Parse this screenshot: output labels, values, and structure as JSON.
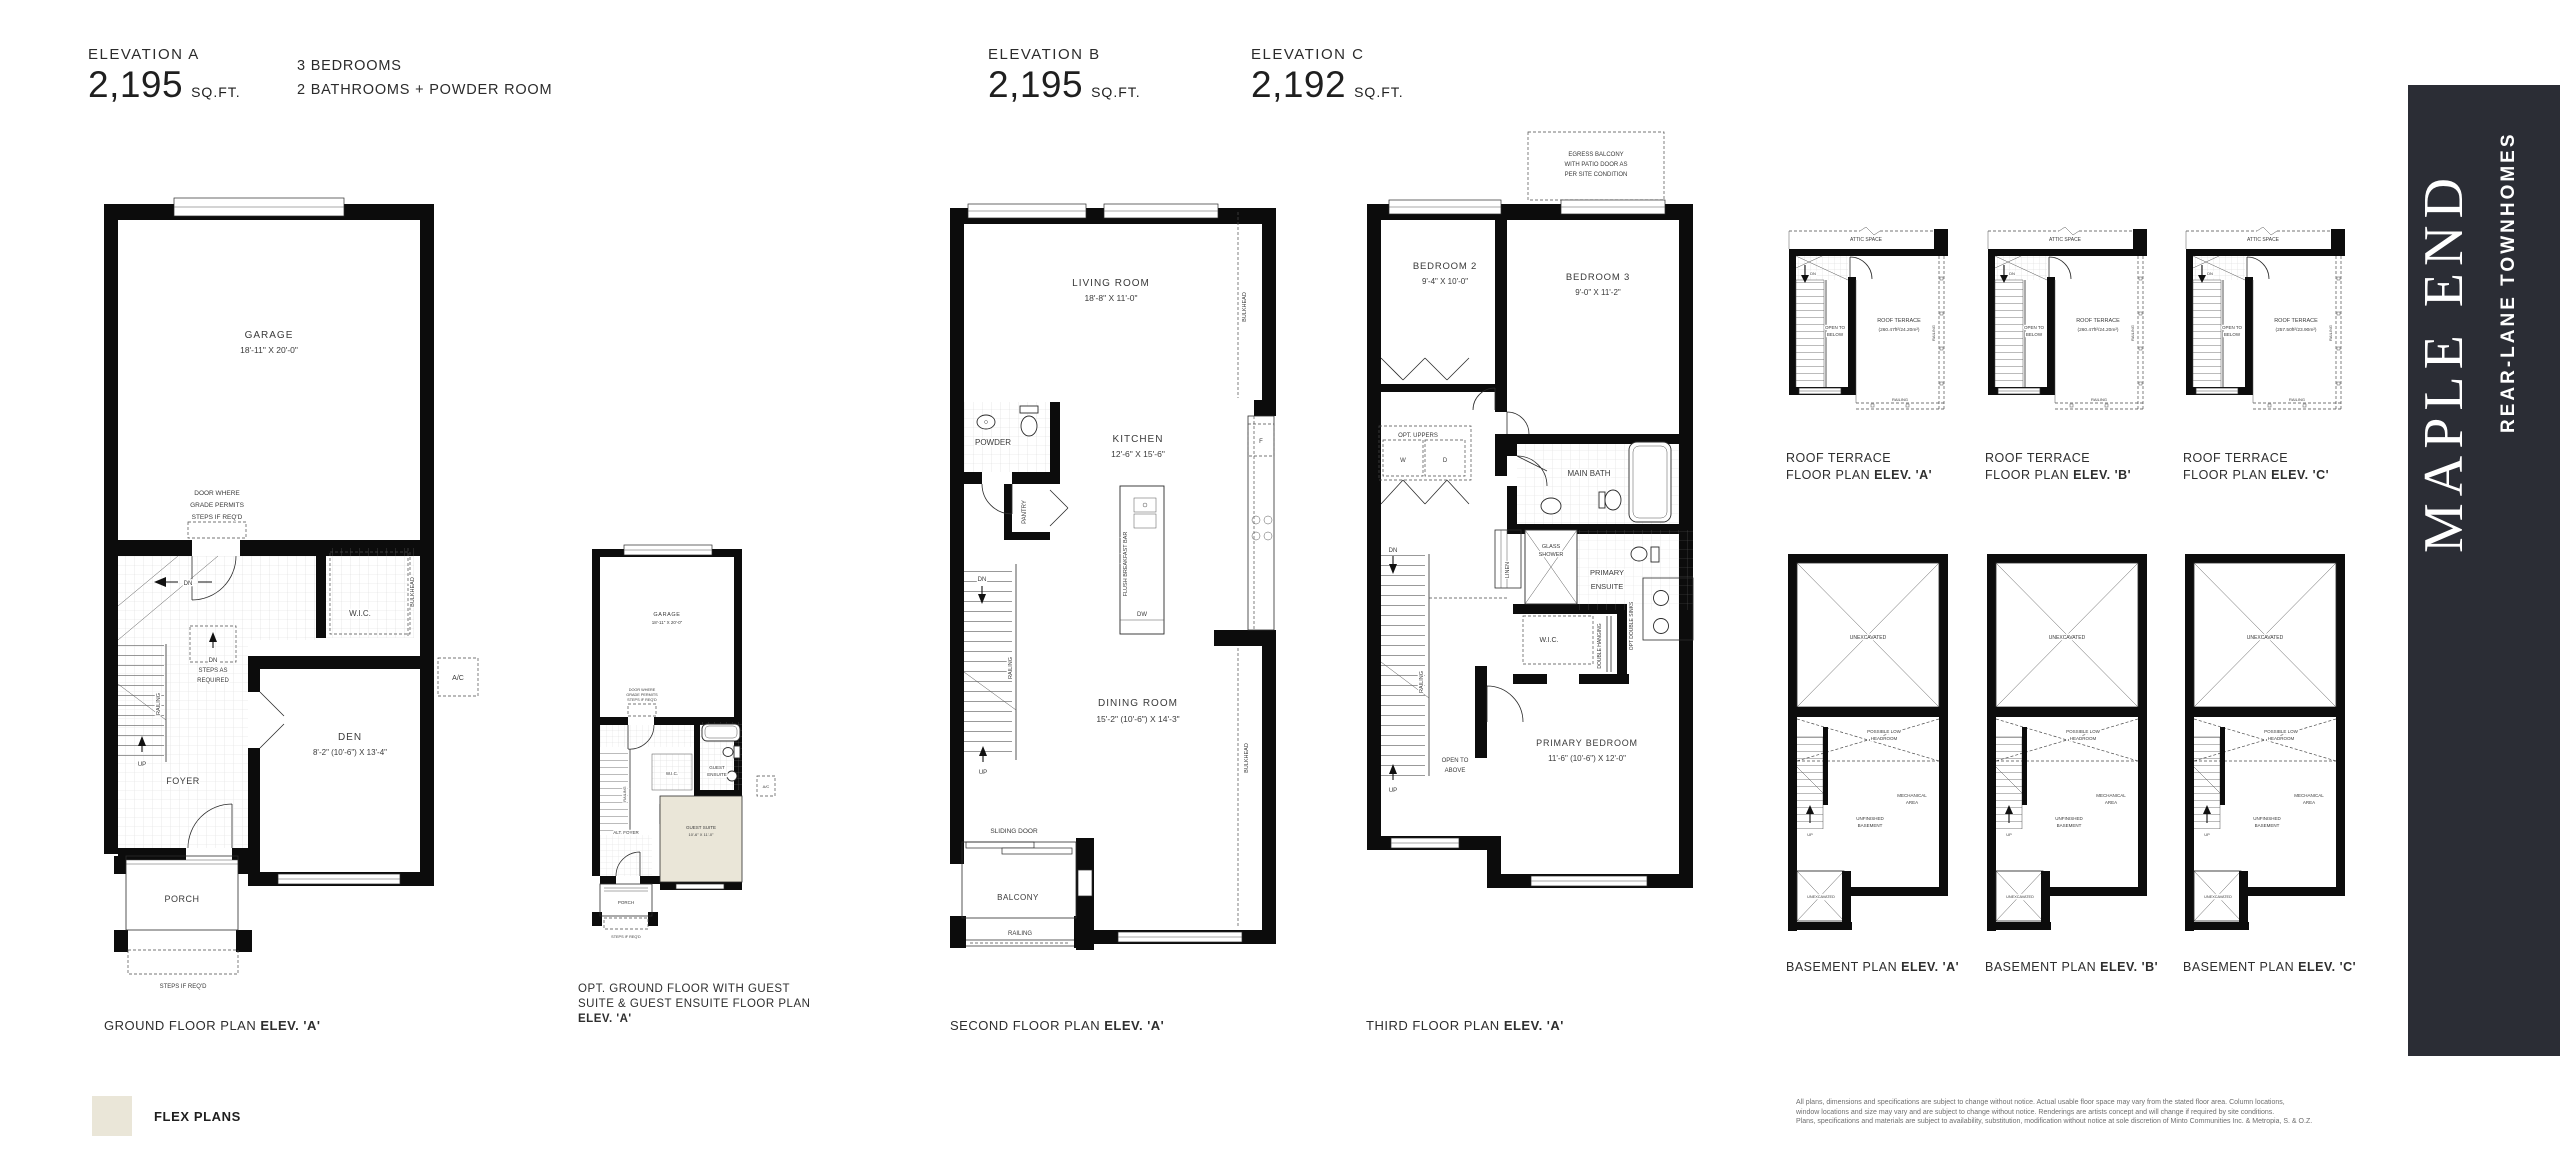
{
  "header": {
    "elevation_a": {
      "label": "ELEVATION A",
      "sqft": "2,195",
      "unit": "SQ.FT."
    },
    "elevation_b": {
      "label": "ELEVATION B",
      "sqft": "2,195",
      "unit": "SQ.FT."
    },
    "elevation_c": {
      "label": "ELEVATION C",
      "sqft": "2,192",
      "unit": "SQ.FT."
    },
    "feature_1": "3 BEDROOMS",
    "feature_2": "2 BATHROOMS + POWDER ROOM"
  },
  "sidebar": {
    "title": "MAPLE END",
    "subtitle": "REAR-LANE TOWNHOMES",
    "bg": "#2b2d35"
  },
  "legend": {
    "label": "FLEX PLANS",
    "swatch_color": "#eae6d8"
  },
  "disclaimer": {
    "line1": "All plans, dimensions and specifications are subject to change without notice. Actual usable floor space may vary from the stated floor area. Column locations,",
    "line2": "window locations and size may vary and are subject to change without notice. Renderings are artists concept and will change if required by site conditions.",
    "line3": "Plans, specifications and materials are subject to availability, substitution, modification without notice at sole discretion of Minto Communities Inc. & Metropia, S. & O.Z."
  },
  "ground": {
    "caption_text": "GROUND FLOOR PLAN",
    "caption_bold": "ELEV. 'A'",
    "garage": "GARAGE",
    "garage_dim": "18'-11\" X 20'-0\"",
    "door_note_1": "DOOR WHERE",
    "door_note_2": "GRADE PERMITS",
    "door_note_3": "STEPS IF REQ'D",
    "wic": "W.I.C.",
    "bulkhead": "BULKHEAD",
    "dn": "DN",
    "steps_1": "DN",
    "steps_2": "STEPS AS",
    "steps_3": "REQUIRED",
    "railing": "RAILING",
    "up": "UP",
    "foyer": "FOYER",
    "den": "DEN",
    "den_dim": "8'-2\" (10'-6\") X 13'-4\"",
    "ac": "A/C",
    "porch": "PORCH",
    "steps_req": "STEPS IF REQ'D"
  },
  "opt_ground": {
    "caption_1": "OPT. GROUND FLOOR WITH GUEST",
    "caption_2": "SUITE & GUEST ENSUITE FLOOR PLAN",
    "caption_bold": "ELEV. 'A'",
    "garage": "GARAGE",
    "garage_dim": "18'-11\" X 20'-0\"",
    "door_note_1": "DOOR WHERE",
    "door_note_2": "GRADE PERMITS",
    "door_note_3": "STEPS IF REQ'D",
    "wic": "W.I.C.",
    "guest_ensuite_1": "GUEST",
    "guest_ensuite_2": "ENSUITE",
    "guest_suite": "GUEST SUITE",
    "guest_suite_dim": "10'-6\" X 11'-0\"",
    "alt_foyer": "ALT. FOYER",
    "railing": "RAILING",
    "porch": "PORCH",
    "steps_req": "STEPS IF REQ'D",
    "ac": "A/C"
  },
  "second": {
    "caption_text": "SECOND FLOOR PLAN",
    "caption_bold": "ELEV. 'A'",
    "living": "LIVING ROOM",
    "living_dim": "18'-8\" X 11'-0\"",
    "bulkhead": "BULKHEAD",
    "powder": "POWDER",
    "kitchen": "KITCHEN",
    "kitchen_dim": "12'-6\" X 15'-6\"",
    "pantry": "PANTRY",
    "breakfast_bar": "FLUSH BREAKFAST BAR",
    "fridge": "F",
    "dw": "DW",
    "dn": "DN",
    "railing": "RAILING",
    "up": "UP",
    "dining": "DINING ROOM",
    "dining_dim": "15'-2\" (10'-6\") X 14'-3\"",
    "sliding_door": "SLIDING DOOR",
    "balcony": "BALCONY",
    "railing2": "RAILING"
  },
  "third": {
    "caption_text": "THIRD FLOOR PLAN",
    "caption_bold": "ELEV. 'A'",
    "egress_1": "EGRESS BALCONY",
    "egress_2": "WITH PATIO DOOR AS",
    "egress_3": "PER SITE CONDITION",
    "bedroom2": "BEDROOM 2",
    "bedroom2_dim": "9'-4\" X 10'-0\"",
    "bedroom3": "BEDROOM 3",
    "bedroom3_dim": "9'-0\" X 11'-2\"",
    "opt_uppers": "OPT. UPPERS",
    "washer": "W",
    "dryer": "D",
    "main_bath": "MAIN BATH",
    "dn": "DN",
    "linen": "LINEN",
    "glass_shower_1": "GLASS",
    "glass_shower_2": "SHOWER",
    "primary_ensuite_1": "PRIMARY",
    "primary_ensuite_2": "ENSUITE",
    "opt_double_sinks": "OPT DOUBLE SINKS",
    "wic": "W.I.C.",
    "double_hanging": "DOUBLE HANGING",
    "railing": "RAILING",
    "open_1": "OPEN TO",
    "open_2": "ABOVE",
    "up": "UP",
    "primary_bedroom": "PRIMARY BEDROOM",
    "primary_bedroom_dim": "11'-6\" (10'-6\") X 12'-0\""
  },
  "roof": {
    "attic": "ATTIC SPACE",
    "dn": "DN",
    "open_1": "OPEN TO",
    "open_2": "BELOW",
    "terrace": "ROOF TERRACE",
    "railing": "RAILING",
    "plans": [
      {
        "area": "(260.47ft²/24.20m²)",
        "caption_1": "ROOF TERRACE",
        "caption_2": "FLOOR PLAN",
        "caption_bold": "ELEV. 'A'"
      },
      {
        "area": "(260.47ft²/24.20m²)",
        "caption_1": "ROOF TERRACE",
        "caption_2": "FLOOR PLAN",
        "caption_bold": "ELEV. 'B'"
      },
      {
        "area": "(257.50ft²/23.90m²)",
        "caption_1": "ROOF TERRACE",
        "caption_2": "FLOOR PLAN",
        "caption_bold": "ELEV. 'C'"
      }
    ]
  },
  "basement": {
    "unexcavated": "UNEXCAVATED",
    "low_1": "POSSIBLE LOW",
    "low_2": "HEADROOM",
    "mech_1": "MECHANICAL",
    "mech_2": "AREA",
    "unfin_1": "UNFINISHED",
    "unfin_2": "BASEMENT",
    "up": "UP",
    "unexcavated_small": "UNEXCAVATED",
    "plans": [
      {
        "caption_text": "BASEMENT PLAN",
        "caption_bold": "ELEV. 'A'"
      },
      {
        "caption_text": "BASEMENT PLAN",
        "caption_bold": "ELEV. 'B'"
      },
      {
        "caption_text": "BASEMENT PLAN",
        "caption_bold": "ELEV. 'C'"
      }
    ]
  }
}
